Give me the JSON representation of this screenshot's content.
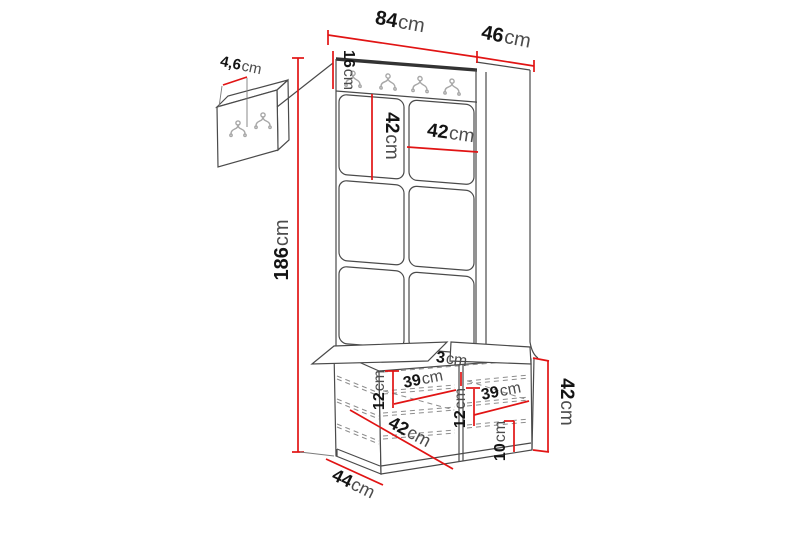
{
  "diagram": {
    "description": "hallway furniture set dimension drawing",
    "unit_count_hooks_rail": 4,
    "unit_count_hooks_wall_panel": 2
  },
  "colors": {
    "dimension_line": "#e11414",
    "outline": "#4a4a4a",
    "dark_edge": "#333333",
    "hook": "#a7a7a7",
    "background": "#ffffff"
  },
  "dimensions": {
    "total_width": {
      "value": "84",
      "unit": "cm"
    },
    "total_depth": {
      "value": "46",
      "unit": "cm"
    },
    "total_height": {
      "value": "186",
      "unit": "cm"
    },
    "rail_height": {
      "value": "16",
      "unit": "cm"
    },
    "panel_height": {
      "value": "42",
      "unit": "cm"
    },
    "panel_width": {
      "value": "42",
      "unit": "cm"
    },
    "wall_panel_thickness": {
      "value": "4,6",
      "unit": "cm"
    },
    "divider_thickness": {
      "value": "3",
      "unit": "cm"
    },
    "seat_clearance_left": {
      "value": "12",
      "unit": "cm"
    },
    "door_width_left": {
      "value": "39",
      "unit": "cm"
    },
    "shelf_clearance_mid": {
      "value": "12",
      "unit": "cm"
    },
    "door_width_right": {
      "value": "39",
      "unit": "cm"
    },
    "plinth_height": {
      "value": "10",
      "unit": "cm"
    },
    "bench_height": {
      "value": "42",
      "unit": "cm"
    },
    "bench_inner_depth": {
      "value": "42",
      "unit": "cm"
    },
    "bench_depth": {
      "value": "44",
      "unit": "cm"
    }
  }
}
